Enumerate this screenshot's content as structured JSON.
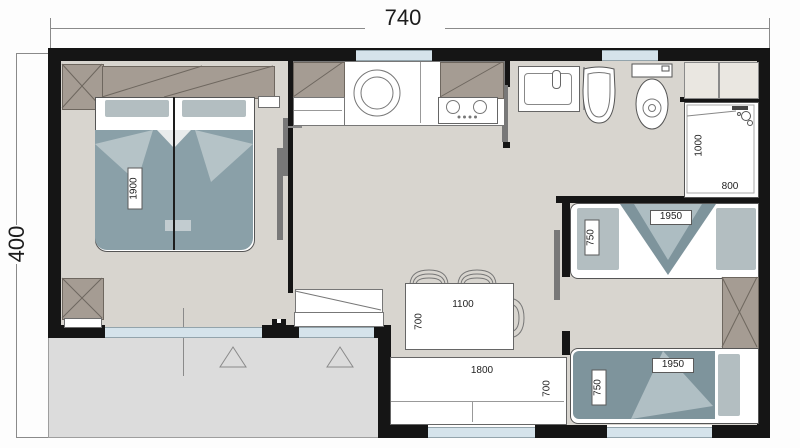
{
  "title": "mobile-home floor plan",
  "dims": {
    "width": "740",
    "height": "400"
  },
  "rooms": {
    "bedroom_master": {
      "bed_length": "1900"
    },
    "bathroom": {
      "shower_depth": "1000",
      "shower_width": "800"
    },
    "bedroom_kids": {
      "bed_top_width": "750",
      "bed_top_length": "1950",
      "bed_bottom_width": "750",
      "bed_bottom_length": "1950"
    },
    "living": {
      "table_length": "1100",
      "table_depth": "700",
      "sofa_length": "1800",
      "sofa_depth": "700"
    }
  },
  "icons": [
    "wardrobe-cross-box",
    "washing-machine",
    "hob",
    "washbasin",
    "bidet",
    "toilet",
    "shower",
    "terrace-triangle-marker"
  ],
  "colors": {
    "wall": "#151515",
    "floor": "#d8d5cf",
    "terrace": "#dcdcdc",
    "window": "#d5e3eb",
    "tan": "#a59c93",
    "tan-line": "#6e675f",
    "cream": "#eae7e1",
    "panel": "#787878",
    "blanket": "#8aa0a8",
    "blanket-light": "#b5c3c7",
    "blanket-dark": "#7e949c",
    "pillow": "#b3bec1",
    "line": "#8a8a8a"
  }
}
